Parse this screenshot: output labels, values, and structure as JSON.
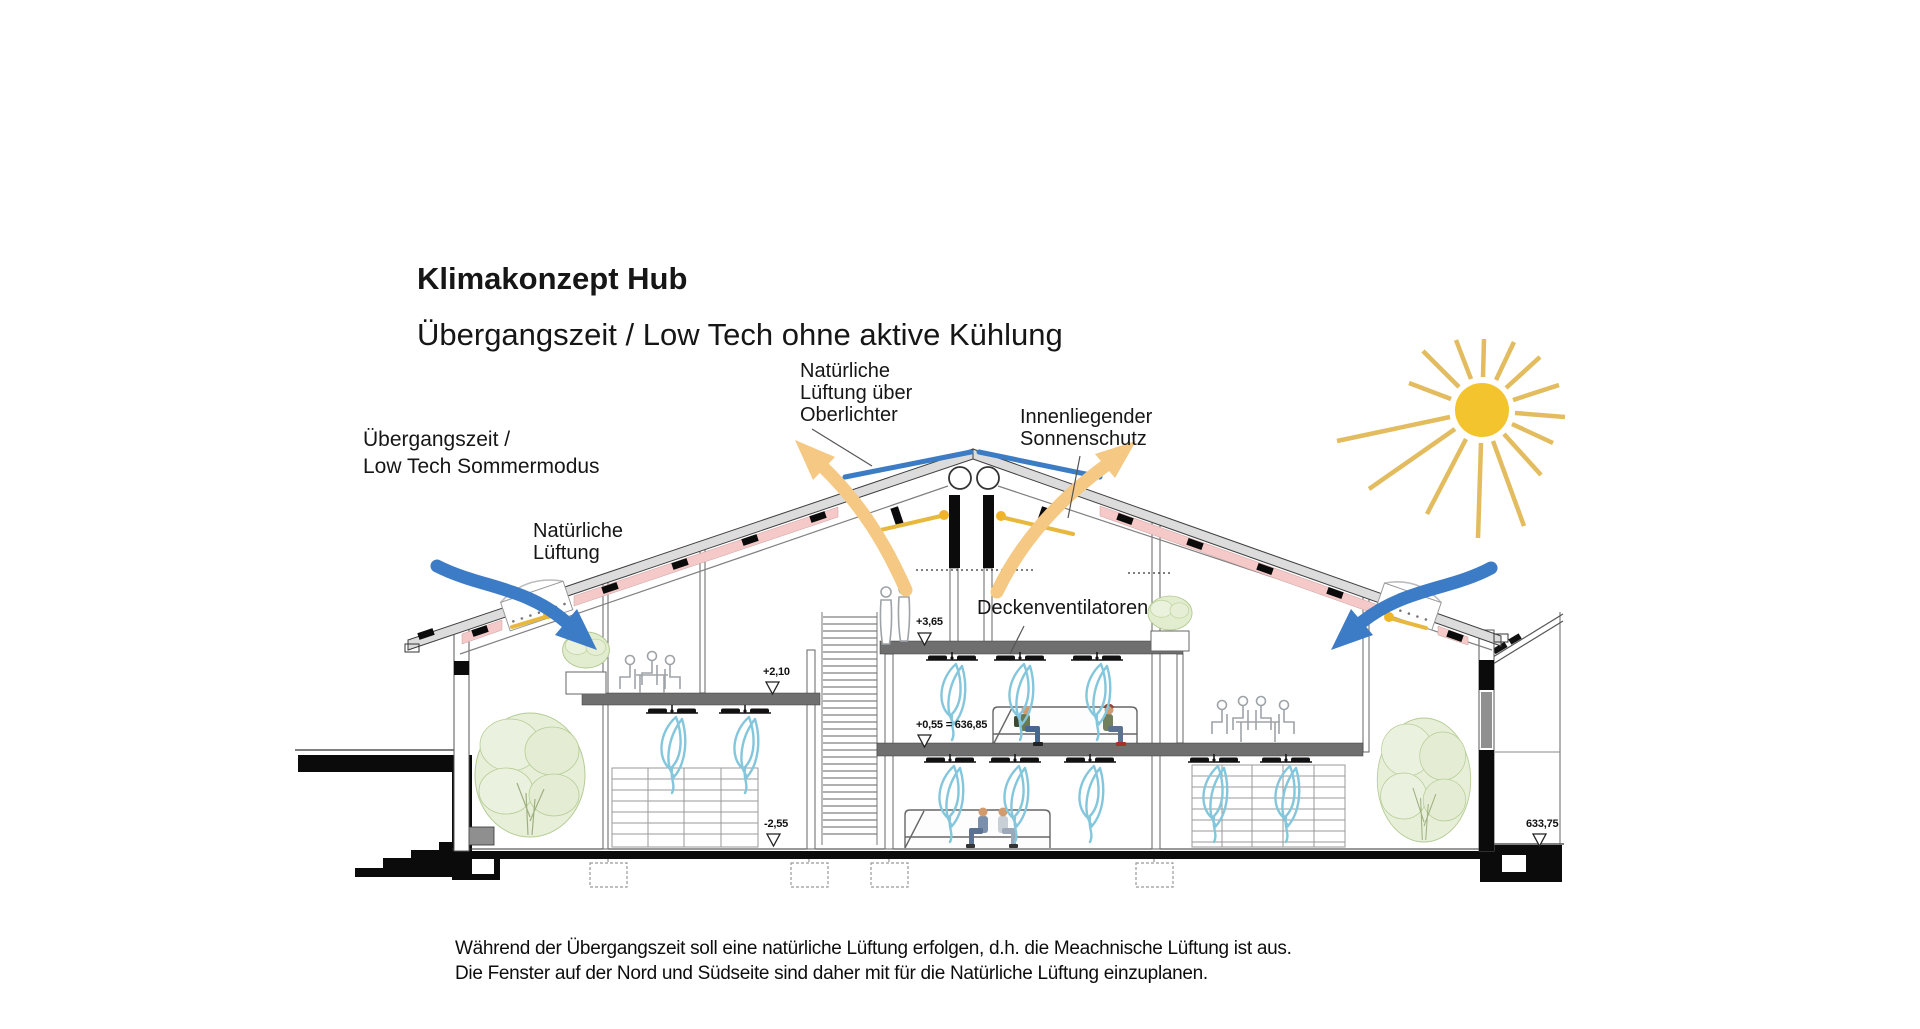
{
  "title": {
    "line1": "Klimakonzept Hub",
    "line2": "Übergangszeit / Low Tech ohne aktive Kühlung"
  },
  "labels": {
    "mode": "Übergangszeit /\nLow Tech Sommermodus",
    "skylight_vent": "Natürliche\nLüftung über\nOberlichter",
    "sun_protection": "Innenliegender\nSonnenschutz",
    "natural_vent": "Natürliche\nLüftung",
    "ceiling_fans": "Deckenventilatoren"
  },
  "elevation_markers": [
    {
      "text": "+3,65"
    },
    {
      "text": "+2,10"
    },
    {
      "text": "+0,55 = 636,85"
    },
    {
      "text": "-2,55"
    },
    {
      "text": "633,75"
    }
  ],
  "footnote": "Während der Übergangszeit soll eine natürliche Lüftung erfolgen, d.h. die Meachnische Lüftung ist aus.\nDie Fenster auf der Nord und Südseite sind daher mit für die Natürliche Lüftung einzuplanen.",
  "colors": {
    "airflow_blue": "#3C7BC5",
    "solar_orange": "#F5C883",
    "skylight_blue": "#3B7CC4",
    "insulation_pink": "#F6C9C9",
    "sun_yellow": "#F4C42F",
    "sun_ray": "#E2BC5F",
    "fan_swirl_blue": "#84C6DC",
    "slab_gray": "#6F6F6F",
    "sunshade_rod_yellow": "#E8B83C"
  }
}
